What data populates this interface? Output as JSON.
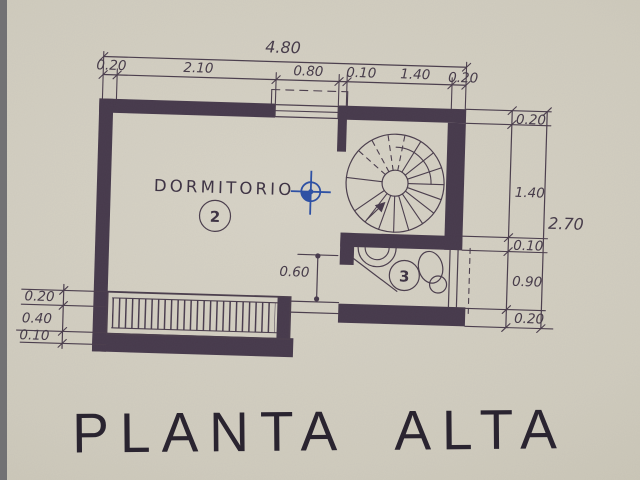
{
  "drawing": {
    "title": "PLANTA ALTA",
    "rooms": [
      {
        "label": "DORMITORIO",
        "number": "2"
      },
      {
        "label": "",
        "number": "3"
      }
    ],
    "dimensions": {
      "top_total": "4.80",
      "top_chain": [
        "0.20",
        "2.10",
        "0.80",
        "0.10",
        "1.40",
        "0.20"
      ],
      "right_total": "2.70",
      "right_chain": [
        "0.20",
        "1.40",
        "0.10",
        "0.90",
        "0.20"
      ],
      "left_chain": [
        "0.20",
        "0.40",
        "0.10"
      ],
      "door_width": "0.60"
    },
    "colors": {
      "ink": "#46394b",
      "paper": "#d0ccbe",
      "pen_blue": "#2b4fa5",
      "title_ink": "#2a2430"
    }
  }
}
